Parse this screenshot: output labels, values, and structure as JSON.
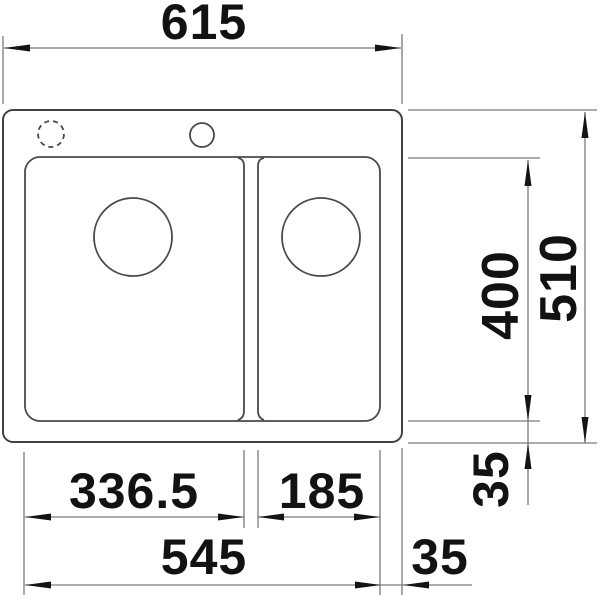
{
  "drawing": {
    "subject": "double-bowl inset sink plan view",
    "units": "mm"
  },
  "dimensions": {
    "overall_width": "615",
    "overall_depth": "510",
    "basin_depth": "400",
    "main_basin_width": "336.5",
    "secondary_basin_width": "185",
    "basins_overall_width": "545",
    "edge_offset_right": "35",
    "edge_offset_bottom": "35"
  },
  "colors": {
    "background": "#ffffff",
    "object_outline": "#424242",
    "dimension_line": "#7b7b7b",
    "annotation": "#121212"
  }
}
